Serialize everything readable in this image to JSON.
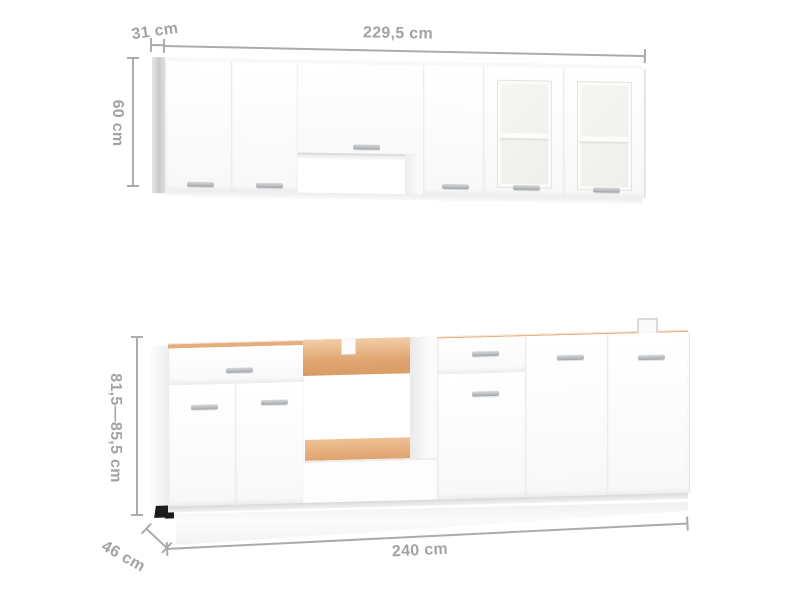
{
  "meta": {
    "title": "Kitchen cabinet set dimension diagram",
    "background": "#ffffff"
  },
  "annotations": {
    "upper_depth": "31 cm",
    "upper_width": "229,5 cm",
    "upper_height": "60 cm",
    "base_height_range": "81,5—85,5 cm",
    "base_depth": "46 cm",
    "base_width": "240 cm"
  },
  "colors": {
    "dimension_text": "#a3a3a3",
    "dimension_line": "#ababab",
    "cabinet_white": "#fcfcfc",
    "side_panel_gray": "#cdcdcd",
    "particleboard_tan": "#e0a571",
    "handle_gray": "#b3b7ba",
    "feet_black": "#1c1c1c",
    "glass_interior": "#f3f3f0"
  }
}
